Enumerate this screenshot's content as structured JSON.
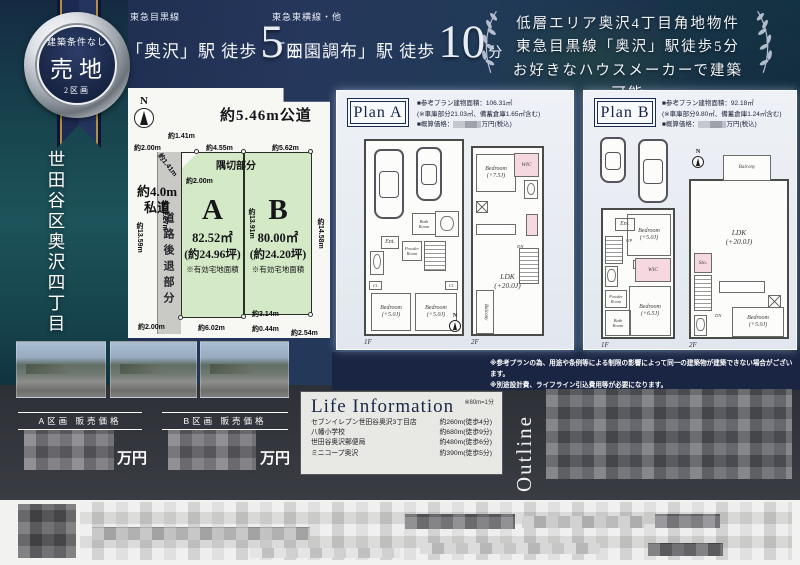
{
  "badge": {
    "top": "建築条件なし",
    "main": "売地",
    "sub": "2区画"
  },
  "access": {
    "a1_line": "東急目黒線",
    "a1_station": "「奥沢」駅 徒歩",
    "a1_num": "5",
    "a1_unit": "分",
    "a2_line": "東急東横線・他",
    "a2_station": "「田園調布」駅 徒歩",
    "a2_num": "10",
    "a2_unit": "分"
  },
  "catchcopy": {
    "line1": "低層エリア奥沢4丁目角地物件",
    "line2": "東急目黒線「奥沢」駅徒歩5分",
    "line3": "お好きなハウスメーカーで建築可能"
  },
  "location": {
    "title": "世田谷区奥沢四丁目"
  },
  "siteplan": {
    "north": "N",
    "road_top": "約5.46m公道",
    "priv1": "約4.0m",
    "priv2": "私道",
    "setback": "道路後退部分",
    "corner": "隅切部分",
    "m141a": "約1.41m",
    "m200a": "約2.00m",
    "m455": "約4.55m",
    "m562": "約5.62m",
    "m141b": "約1.41m",
    "m200b": "約2.00m",
    "m1359": "約13.59m",
    "m1227": "約12.27m",
    "m1391": "約13.91m",
    "m1458": "約14.58m",
    "m200c": "約2.00m",
    "m602": "約6.02m",
    "m314": "約3.14m",
    "m044": "約0.44m",
    "m254": "約2.54m",
    "lotA": {
      "id": "A",
      "area": "82.52㎡",
      "tsubo": "(約24.96坪)",
      "note": "※有効宅地面積"
    },
    "lotB": {
      "id": "B",
      "area": "80.00㎡",
      "tsubo": "(約24.20坪)",
      "note": "※有効宅地面積"
    }
  },
  "planA": {
    "name": "Plan A",
    "spec1": "■参考プラン建物面積：106.31㎡",
    "spec2": "(※車庫部分21.03㎡、備蓄倉庫1.65㎡含む)",
    "price_prefix": "■概算価格：",
    "price_suffix": "万円(税込)",
    "f1": "1F",
    "f2": "2F",
    "rooms": {
      "bath": "Bath\nRoom",
      "ent": "Ent.",
      "powder": "Powder\nRoom",
      "bed1": "Bedroom\n(+5.0J)",
      "bed2": "Bedroom\n(+5.0J)",
      "cl1": "Cl.",
      "cl2": "Cl.",
      "bed3": "Bedroom\n(+7.5J)",
      "wic": "WIC",
      "ldk": "LDK\n(+20.0J)",
      "balcony": "Balcony",
      "dn": "DN"
    }
  },
  "planB": {
    "name": "Plan B",
    "spec1": "■参考プラン建物面積：92.18㎡",
    "spec2": "(※車庫部分9.80㎡、備蓄倉庫1.24㎡含む)",
    "price_prefix": "■概算価格：",
    "price_suffix": "万円(税込)",
    "f1": "1F",
    "f2": "2F",
    "rooms": {
      "ent": "Ent.",
      "up": "UP",
      "bed1": "Bedroom\n(+5.0J)",
      "cl": "Cl.",
      "wic": "WIC",
      "powder": "Powder\nRoom",
      "bath": "Bath\nRoom",
      "bed2": "Bedroom\n(+6.5J)",
      "balcony": "Balcony",
      "ldk": "LDK\n(+20.0J)",
      "sto": "Sto.",
      "dn": "DN",
      "bed3": "Bedroom\n(+5.0J)"
    }
  },
  "notes": {
    "line1": "※参考プランの為、用途や条例等による制限の影響によって同一の建築物が建築できない場合がございます。",
    "line2": "※別途設計費、ライフライン引込費用等が必要になります。"
  },
  "prices": {
    "a_label": "A区画 販売価格",
    "b_label": "B区画 販売価格",
    "unit": "万円"
  },
  "lifeinfo": {
    "title": "Life Information",
    "note": "※80m=1分",
    "items": [
      {
        "name": "セブンイレブン世田谷奥沢3丁目店",
        "dist": "約260m(徒歩4分)"
      },
      {
        "name": "八幡小学校",
        "dist": "約680m(徒歩9分)"
      },
      {
        "name": "世田谷奥沢郵便局",
        "dist": "約480m(徒歩6分)"
      },
      {
        "name": "ミニコープ奥沢",
        "dist": "約390m(徒歩5分)"
      }
    ]
  },
  "outline": {
    "title": "Outline"
  },
  "colors": {
    "navy": "#1a2747",
    "gold": "#b08d4a",
    "lot_green": "#d4e9c5",
    "room_pink": "#f6d8e1",
    "panel": "#eef1f6"
  }
}
